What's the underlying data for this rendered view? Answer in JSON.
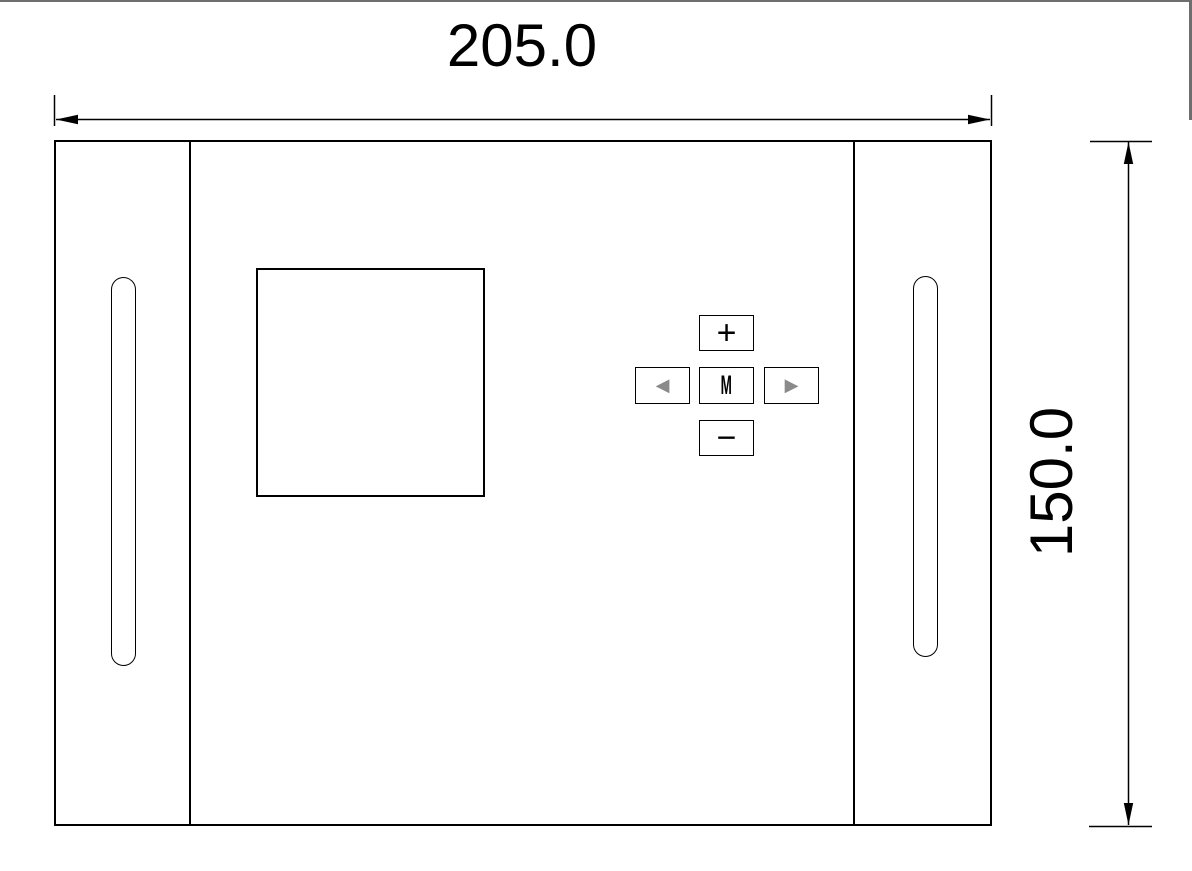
{
  "window": {
    "frame_color": "#6e6e6e"
  },
  "drawing": {
    "type": "cad-front-panel-drawing",
    "width_dim": {
      "label": "205.0"
    },
    "height_dim": {
      "label": "150.0"
    },
    "panel": {
      "buttons": {
        "plus": "+",
        "left": "◀",
        "menu": "M",
        "right": "▶",
        "minus": "−"
      }
    },
    "colors": {
      "line": "#000000",
      "nav_arrow": "#8a8a8a"
    }
  }
}
